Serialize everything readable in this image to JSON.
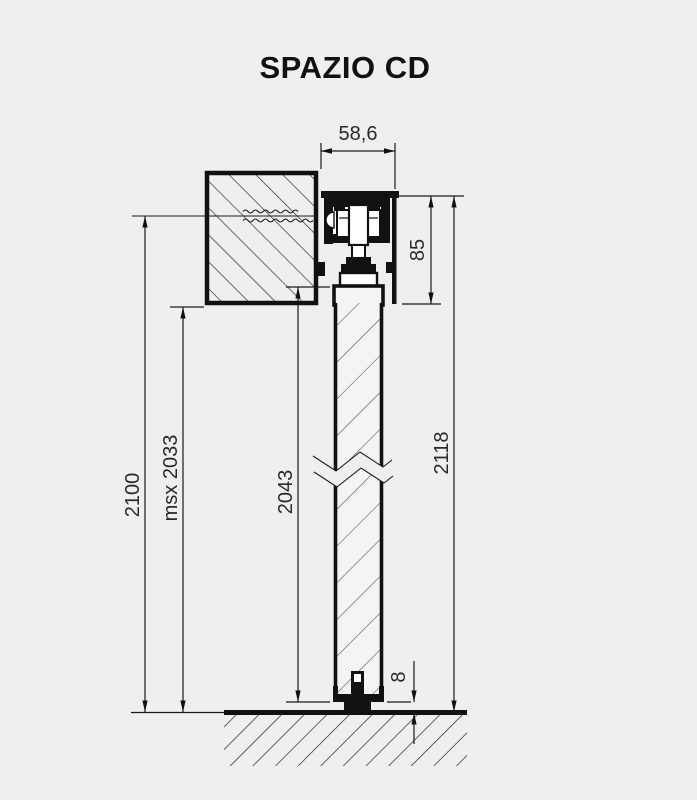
{
  "title": "SPAZIO CD",
  "dims": {
    "track_width": "58,6",
    "track_height": "85",
    "overall_height": "2118",
    "fixing_height": "2100",
    "passage_height": "msx 2033",
    "door_height": "2043",
    "floor_gap": "8"
  },
  "colors": {
    "background": "#efefef",
    "line": "#111111",
    "dim_text": "#2a2a2a"
  }
}
